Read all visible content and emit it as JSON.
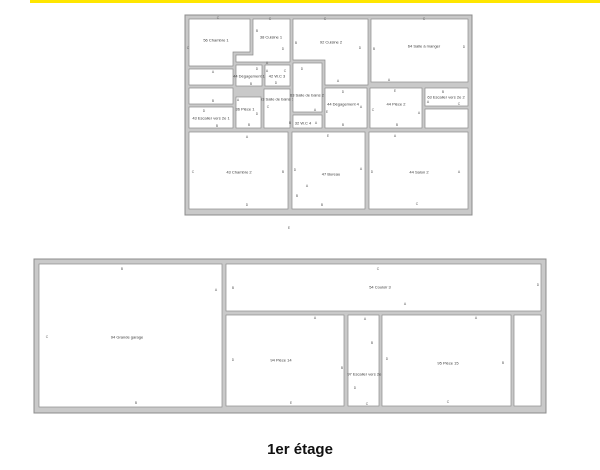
{
  "page": {
    "caption": "1er étage",
    "background": "#ffffff"
  },
  "top_bar": {
    "color": "#ffe600"
  },
  "colors": {
    "wall_fill": "#c9c9c9",
    "wall_stroke": "#8c8c8c",
    "room_fill": "#ffffff",
    "label": "#3a3a3a",
    "letter": "#5a5a5a"
  },
  "plan_text": {
    "label_size": 4,
    "letter_size": 3.4
  },
  "floor_plans": [
    {
      "id": "upper-plan",
      "frame": {
        "x": 185,
        "y": 15,
        "w": 287,
        "h": 200
      },
      "rooms": [
        {
          "id": "chambre-1",
          "label": "56 Chambre 1",
          "label_pos": [
            216,
            40
          ],
          "poly": [
            [
              189,
              19
            ],
            [
              250,
              19
            ],
            [
              250,
              52
            ],
            [
              233,
              52
            ],
            [
              233,
              66
            ],
            [
              189,
              66
            ]
          ]
        },
        {
          "id": "cuisine-1",
          "label": "38 Cuisine 1",
          "label_pos": [
            271,
            37
          ],
          "poly": [
            [
              253,
              19
            ],
            [
              290,
              19
            ],
            [
              290,
              62
            ],
            [
              236,
              62
            ],
            [
              236,
              55
            ],
            [
              253,
              55
            ]
          ]
        },
        {
          "id": "cuisine-2",
          "label": "92 Cuisine 2",
          "label_pos": [
            331,
            42
          ],
          "poly": [
            [
              293,
              19
            ],
            [
              368,
              19
            ],
            [
              368,
              85
            ],
            [
              325,
              85
            ],
            [
              325,
              60
            ],
            [
              293,
              60
            ]
          ]
        },
        {
          "id": "salle-a-manger",
          "label": "64 Salle à manger",
          "label_pos": [
            424,
            46
          ],
          "rect": [
            371,
            19,
            468,
            82
          ]
        },
        {
          "id": "hall-1",
          "label": "",
          "label_pos": [
            211,
            77
          ],
          "rect": [
            189,
            69,
            233,
            85
          ]
        },
        {
          "id": "hall-2",
          "label": "",
          "label_pos": [
            211,
            96
          ],
          "rect": [
            189,
            88,
            233,
            104
          ]
        },
        {
          "id": "escalier-1",
          "label": "43 Escalier vers 2e 1",
          "label_pos": [
            211,
            118
          ],
          "rect": [
            189,
            107,
            233,
            128
          ]
        },
        {
          "id": "degagement-1",
          "label": "44 Dégagement 1",
          "label_pos": [
            249,
            76
          ],
          "rect": [
            236,
            65,
            262,
            86
          ]
        },
        {
          "id": "wc-3",
          "label": "42 W.C 3",
          "label_pos": [
            277,
            76
          ],
          "rect": [
            265,
            65,
            290,
            86
          ]
        },
        {
          "id": "salle-de-bains-1",
          "label": "63 Salle de bains 1",
          "label_pos": [
            277,
            99
          ],
          "rect": [
            264,
            89,
            290,
            128
          ]
        },
        {
          "id": "salle-de-bains-2",
          "label": "63 Salle de bains 2",
          "label_pos": [
            307,
            95
          ],
          "rect": [
            293,
            63,
            322,
            112
          ]
        },
        {
          "id": "wc-4",
          "label": "32 W.C 4",
          "label_pos": [
            303,
            123
          ],
          "rect": [
            293,
            115,
            322,
            128
          ]
        },
        {
          "id": "piece-1",
          "label": "36 Pièce 1",
          "label_pos": [
            245,
            109
          ],
          "rect": [
            236,
            97,
            261,
            128
          ]
        },
        {
          "id": "degagement-4",
          "label": "44 Dégagement 4",
          "label_pos": [
            343,
            104
          ],
          "rect": [
            325,
            88,
            367,
            128
          ]
        },
        {
          "id": "piece-2",
          "label": "44 Pièce 2",
          "label_pos": [
            396,
            104
          ],
          "rect": [
            370,
            88,
            422,
            128
          ]
        },
        {
          "id": "escalier-2",
          "label": "63 Escalier vers 2e 2",
          "label_pos": [
            446,
            97
          ],
          "rect": [
            425,
            88,
            468,
            106
          ]
        },
        {
          "id": "reduit",
          "label": "",
          "label_pos": [
            446,
            118
          ],
          "rect": [
            425,
            109,
            468,
            128
          ]
        },
        {
          "id": "chambre-2",
          "label": "43 Chambre 2",
          "label_pos": [
            239,
            172
          ],
          "rect": [
            189,
            132,
            288,
            209
          ]
        },
        {
          "id": "bureau",
          "label": "47 Bureau",
          "label_pos": [
            331,
            174
          ],
          "rect": [
            292,
            132,
            365,
            209
          ]
        },
        {
          "id": "salon-2",
          "label": "44 Salon 2",
          "label_pos": [
            419,
            172
          ],
          "rect": [
            369,
            132,
            468,
            209
          ]
        }
      ],
      "letters": [
        [
          "C",
          218,
          18
        ],
        [
          "C",
          188,
          48
        ],
        [
          "A",
          213,
          72
        ],
        [
          "B",
          213,
          101
        ],
        [
          "C",
          270,
          19
        ],
        [
          "B",
          257,
          31
        ],
        [
          "D",
          283,
          49
        ],
        [
          "A",
          267,
          63
        ],
        [
          "C",
          325,
          19
        ],
        [
          "B",
          296,
          43
        ],
        [
          "D",
          360,
          48
        ],
        [
          "A",
          338,
          81
        ],
        [
          "C",
          424,
          19
        ],
        [
          "B",
          374,
          49
        ],
        [
          "D",
          464,
          47
        ],
        [
          "A",
          389,
          80
        ],
        [
          "D",
          257,
          69
        ],
        [
          "B",
          251,
          84
        ],
        [
          "A",
          267,
          71
        ],
        [
          "C",
          285,
          71
        ],
        [
          "D",
          276,
          83
        ],
        [
          "D",
          302,
          69
        ],
        [
          "A",
          315,
          110
        ],
        [
          "C",
          268,
          107
        ],
        [
          "B",
          290,
          123
        ],
        [
          "A",
          316,
          123
        ],
        [
          "D",
          204,
          111
        ],
        [
          "B",
          217,
          126
        ],
        [
          "A",
          238,
          100
        ],
        [
          "D",
          257,
          114
        ],
        [
          "B",
          249,
          125
        ],
        [
          "D",
          343,
          92
        ],
        [
          "E",
          327,
          112
        ],
        [
          "A",
          361,
          107
        ],
        [
          "B",
          343,
          125
        ],
        [
          "E",
          395,
          91
        ],
        [
          "C",
          373,
          110
        ],
        [
          "A",
          419,
          113
        ],
        [
          "B",
          397,
          125
        ],
        [
          "B",
          443,
          92
        ],
        [
          "A",
          428,
          102
        ],
        [
          "C",
          459,
          104
        ],
        [
          "A",
          247,
          137
        ],
        [
          "C",
          193,
          172
        ],
        [
          "B",
          283,
          172
        ],
        [
          "D",
          247,
          205
        ],
        [
          "E",
          328,
          136
        ],
        [
          "D",
          295,
          170
        ],
        [
          "A",
          361,
          169
        ],
        [
          "A",
          307,
          186
        ],
        [
          "B",
          297,
          196
        ],
        [
          "B",
          322,
          205
        ],
        [
          "A",
          395,
          136
        ],
        [
          "D",
          372,
          172
        ],
        [
          "A",
          459,
          172
        ],
        [
          "C",
          417,
          204
        ],
        [
          "E",
          289,
          228
        ]
      ]
    },
    {
      "id": "lower-plan",
      "frame": {
        "x": 34,
        "y": 259,
        "w": 512,
        "h": 154
      },
      "rooms": [
        {
          "id": "grande-garage",
          "label": "94 Grande garage",
          "label_pos": [
            127,
            337
          ],
          "rect": [
            39,
            264,
            222,
            407
          ]
        },
        {
          "id": "couloir-3",
          "label": "54 Couloir 3",
          "label_pos": [
            380,
            287
          ],
          "rect": [
            226,
            264,
            541,
            311
          ]
        },
        {
          "id": "piece-14",
          "label": "94 Pièce 14",
          "label_pos": [
            281,
            360
          ],
          "rect": [
            226,
            315,
            344,
            406
          ]
        },
        {
          "id": "escalier-4",
          "label": "97 Escalier vers 2e 4",
          "label_pos": [
            366,
            374
          ],
          "rect": [
            348,
            315,
            379,
            406
          ]
        },
        {
          "id": "piece-15",
          "label": "95 Pièce 15",
          "label_pos": [
            448,
            363
          ],
          "rect": [
            382,
            315,
            511,
            406
          ]
        },
        {
          "id": "reduit-2",
          "label": "",
          "label_pos": [
            528,
            360
          ],
          "rect": [
            514,
            315,
            541,
            406
          ]
        }
      ],
      "letters": [
        [
          "B",
          122,
          269
        ],
        [
          "A",
          216,
          290
        ],
        [
          "C",
          47,
          337
        ],
        [
          "B",
          136,
          403
        ],
        [
          "C",
          378,
          269
        ],
        [
          "B",
          233,
          288
        ],
        [
          "D",
          538,
          285
        ],
        [
          "A",
          405,
          304
        ],
        [
          "A",
          315,
          318
        ],
        [
          "D",
          233,
          360
        ],
        [
          "B",
          342,
          368
        ],
        [
          "E",
          291,
          403
        ],
        [
          "A",
          365,
          319
        ],
        [
          "B",
          372,
          343
        ],
        [
          "D",
          355,
          388
        ],
        [
          "C",
          367,
          404
        ],
        [
          "A",
          476,
          318
        ],
        [
          "D",
          387,
          359
        ],
        [
          "B",
          503,
          363
        ],
        [
          "C",
          448,
          402
        ]
      ]
    }
  ]
}
